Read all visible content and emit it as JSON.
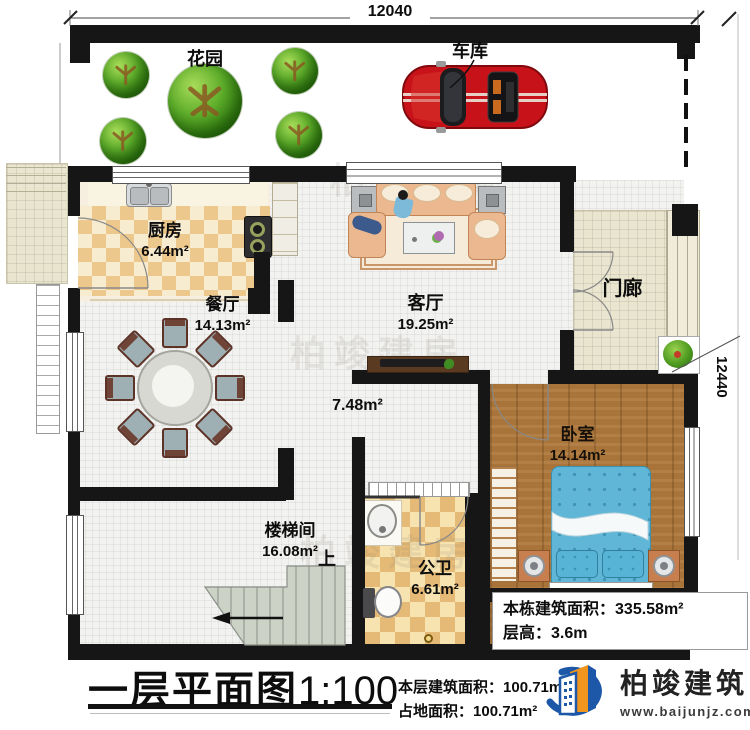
{
  "plan": {
    "dimensions": {
      "top": "12040",
      "right": "12440"
    },
    "watermark": "柏竣建房",
    "rooms": {
      "garden": {
        "label": "花园"
      },
      "garage": {
        "label": "车库"
      },
      "kitchen": {
        "label": "厨房",
        "area": "6.44m²"
      },
      "dining": {
        "label": "餐厅",
        "area": "14.13m²"
      },
      "living": {
        "label": "客厅",
        "area": "19.25m²"
      },
      "porch": {
        "label": "门廊"
      },
      "hallway": {
        "area": "7.48m²"
      },
      "bedroom": {
        "label": "卧室",
        "area": "14.14m²"
      },
      "stairwell": {
        "label": "楼梯间",
        "area": "16.08m²",
        "up": "上"
      },
      "bathroom": {
        "label": "公卫",
        "area": "6.61m²"
      }
    },
    "info_box": {
      "total_area_label": "本栋建筑面积：",
      "total_area_value": "335.58m²",
      "floor_height_label": "层高：",
      "floor_height_value": "3.6m"
    }
  },
  "title_block": {
    "title": "一层平面图",
    "scale": "1:100",
    "floor_area_label": "本层建筑面积：",
    "floor_area_value": "100.71m²",
    "footprint_label": "占地面积：",
    "footprint_value": "100.71m²"
  },
  "logo": {
    "company": "柏竣建筑",
    "website": "www.baijunjz.com"
  },
  "colors": {
    "wall": "#161616",
    "car_red": "#c8121a",
    "bed_blue": "#5fb6d6",
    "wood_floor": "#a9743a",
    "tile_gold": "#e5bc7a",
    "porch_tile": "#eae5cf",
    "stair_green": "#ccd3c6",
    "tree_green": "#4d9b23",
    "brand_blue": "#1d57a7",
    "brand_orange": "#f0951e"
  }
}
